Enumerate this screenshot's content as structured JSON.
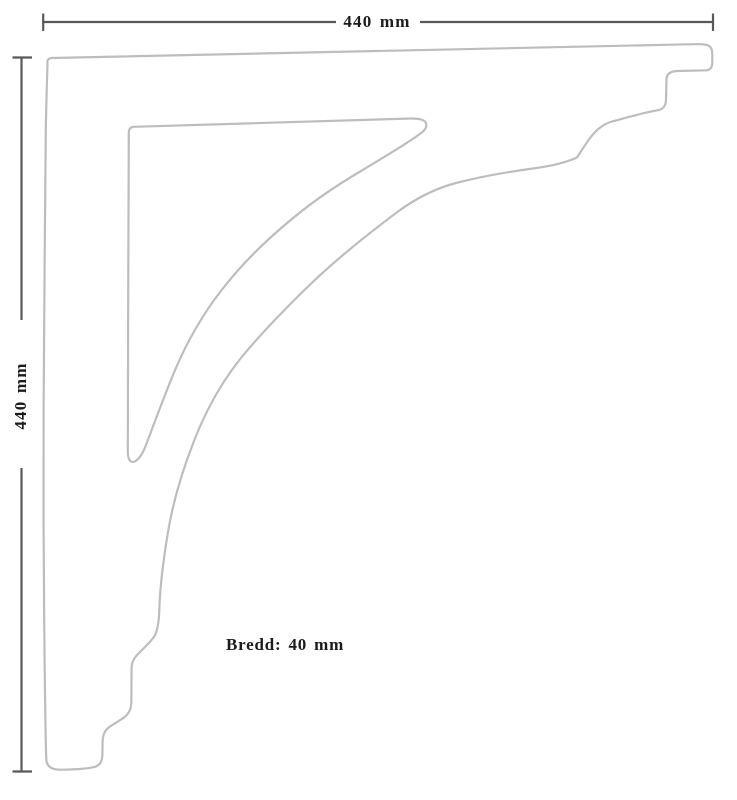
{
  "drawing": {
    "object": "shelf-bracket-profile",
    "dimension_top": "440 mm",
    "dimension_left": "440 mm",
    "width_note": "Bredd: 40 mm",
    "values": {
      "width_mm": 440,
      "height_mm": 440,
      "depth_mm": 40
    }
  },
  "colors": {
    "outline": "#bdbdbd",
    "dimension": "#59595b",
    "text": "#1b1b1b",
    "background": "#ffffff"
  }
}
